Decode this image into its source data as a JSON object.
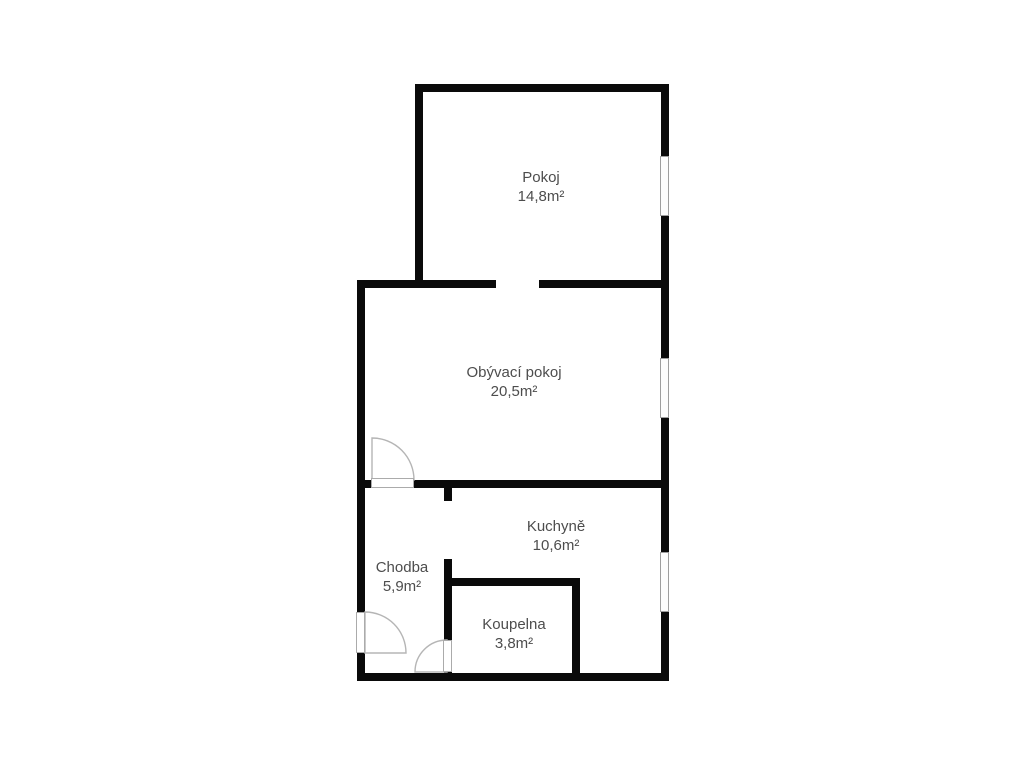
{
  "rooms": [
    {
      "name": "Pokoj",
      "area": "14,8m²"
    },
    {
      "name": "Obývací pokoj",
      "area": "20,5m²"
    },
    {
      "name": "Kuchyně",
      "area": "10,6m²"
    },
    {
      "name": "Chodba",
      "area": "5,9m²"
    },
    {
      "name": "Koupelna",
      "area": "3,8m²"
    }
  ],
  "features": {
    "windows": [
      "pokoj-window",
      "obyvaci-pokoj-window",
      "kuchyne-window"
    ],
    "doors": [
      "obyvaci-pokoj-door",
      "entrance-door",
      "koupelna-door"
    ],
    "wall_openings": [
      "pokoj-passage",
      "kuchyne-passage"
    ]
  },
  "colors": {
    "wall": "#0a0a0a",
    "label_text": "#4d4d4d",
    "door_arc": "#b5b5b5",
    "window_border": "#9e9e9e",
    "background": "#ffffff"
  }
}
